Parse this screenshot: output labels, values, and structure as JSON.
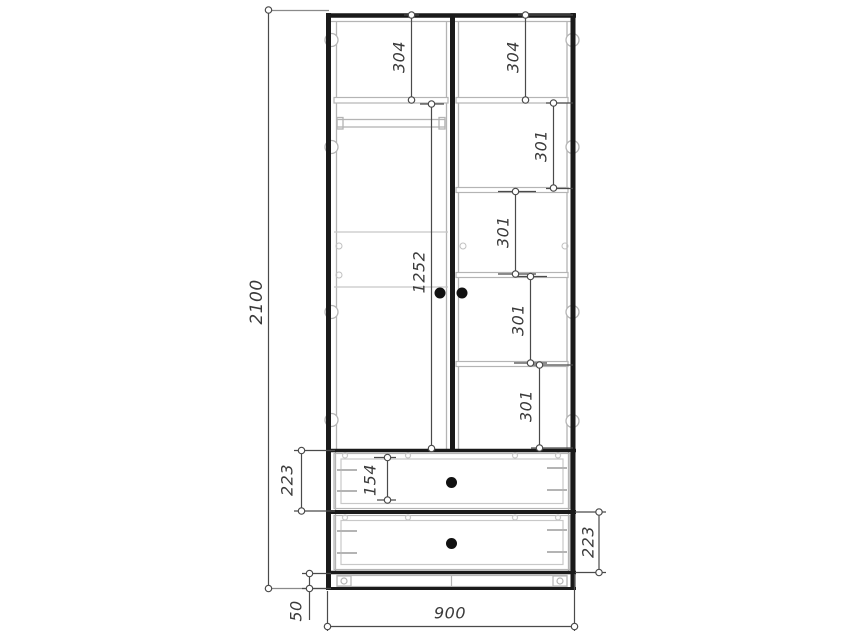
{
  "drawing": {
    "kind": "wardrobe front-view technical drawing",
    "colors": {
      "background": "#ffffff",
      "outline": "#1a1a1a",
      "detail": "#b4b4b4",
      "dimension_line": "#4a4a4a",
      "knob": "#111111"
    }
  },
  "dimensions": {
    "overall_height": "2100",
    "overall_width": "900",
    "plinth_height": "50",
    "left_top_section": "304",
    "right_top_section": "304",
    "right_section_1": "301",
    "right_section_2": "301",
    "right_section_3": "301",
    "right_section_4": "301",
    "door_opening_height": "1252",
    "upper_drawer_section": "223",
    "drawer_box_height": "154",
    "lower_drawer_section": "223"
  }
}
